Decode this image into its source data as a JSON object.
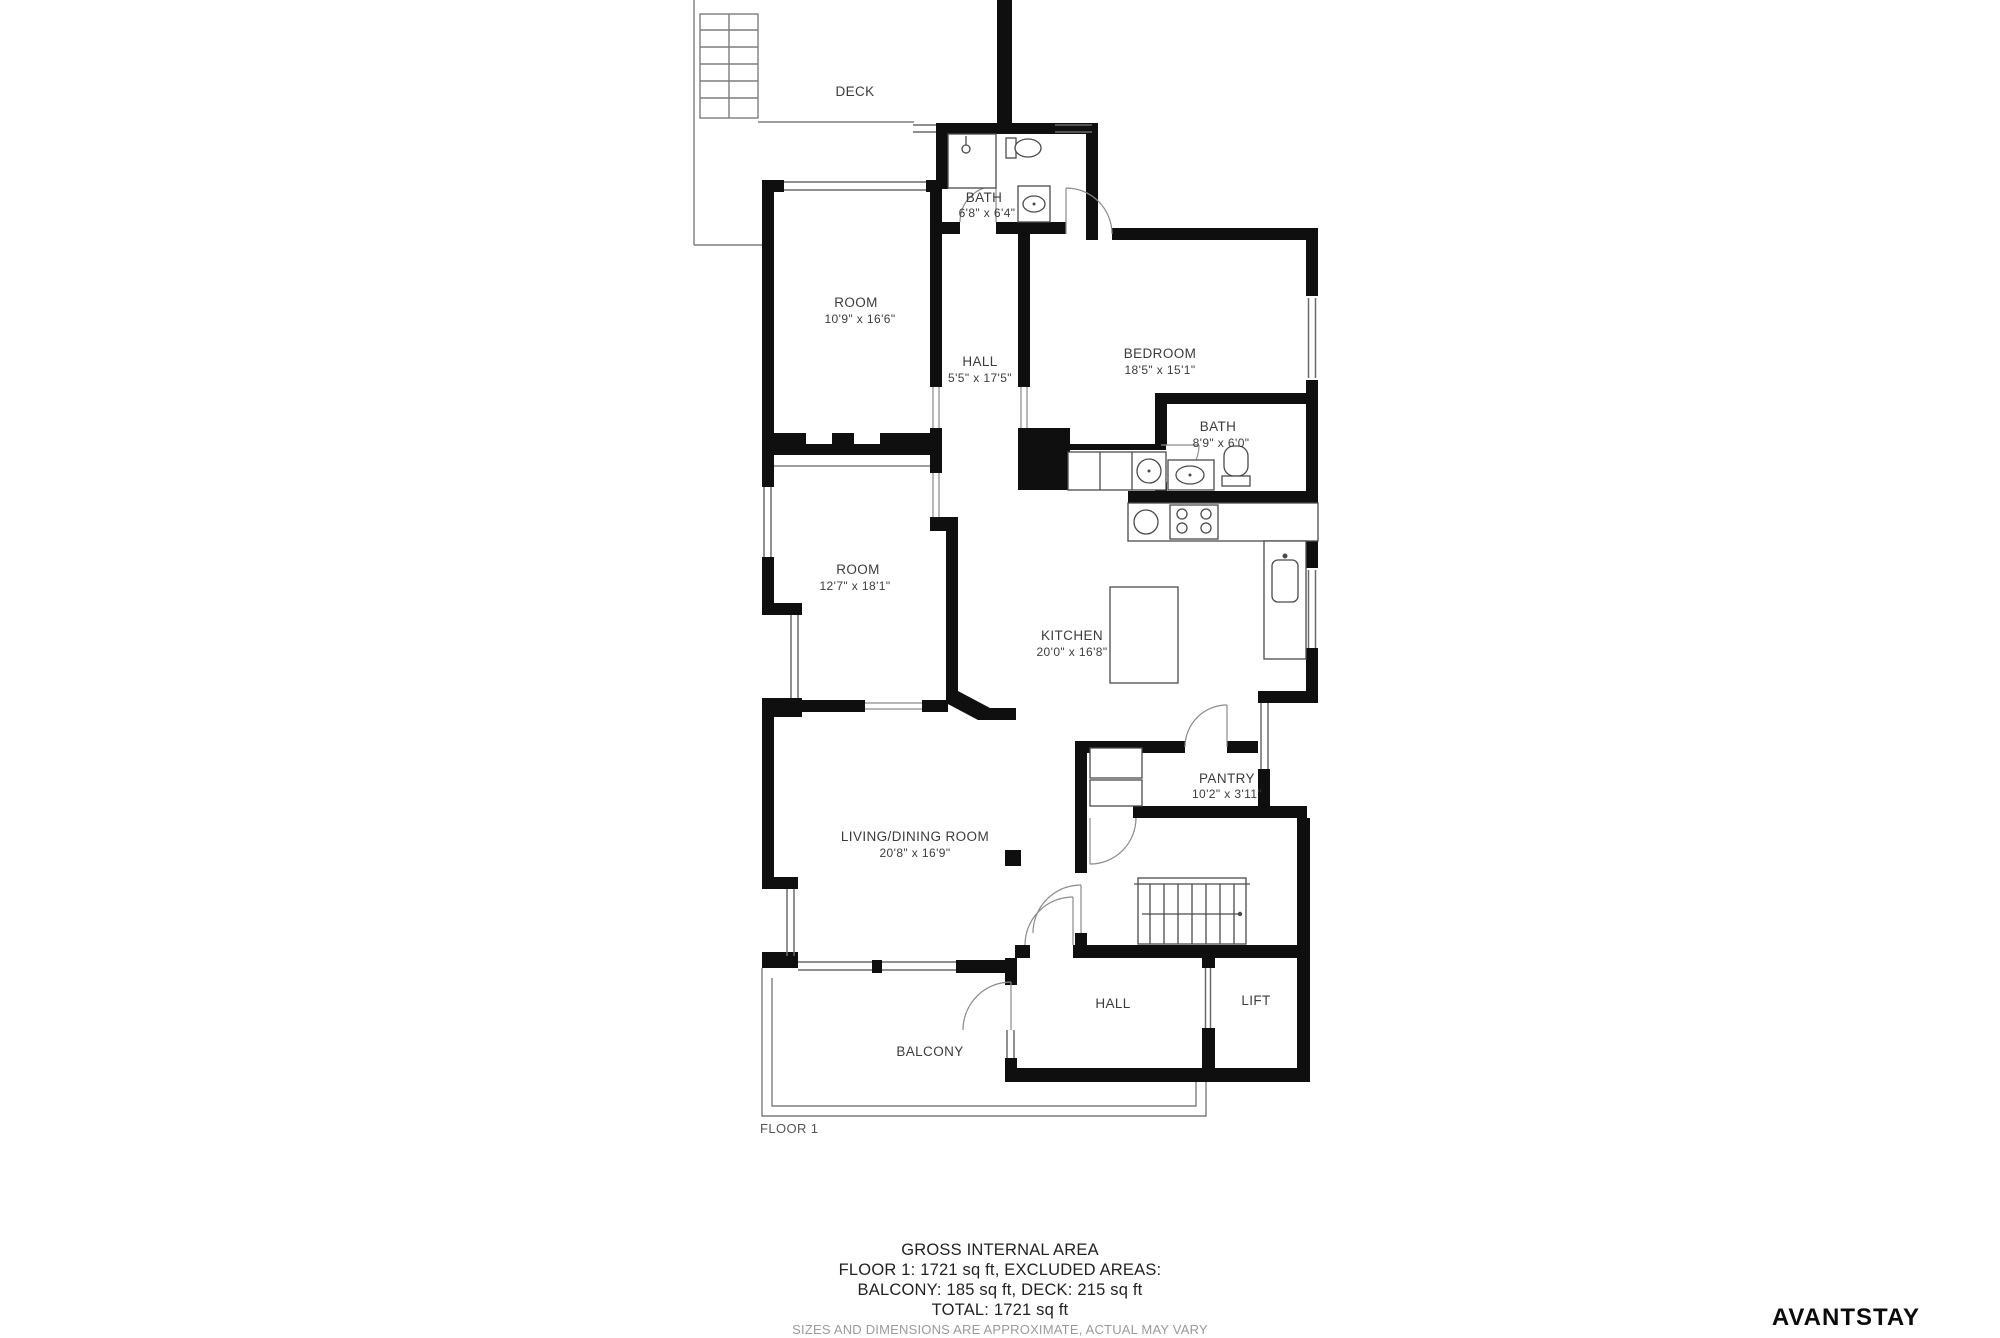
{
  "plan": {
    "floor_label": "FLOOR 1",
    "rooms": {
      "deck": {
        "name": "DECK"
      },
      "bath1": {
        "name": "BATH",
        "dims": "6'8\" x 6'4\""
      },
      "room1": {
        "name": "ROOM",
        "dims": "10'9\" x 16'6\""
      },
      "hall1": {
        "name": "HALL",
        "dims": "5'5\" x 17'5\""
      },
      "bedroom": {
        "name": "BEDROOM",
        "dims": "18'5\" x 15'1\""
      },
      "bath2": {
        "name": "BATH",
        "dims": "8'9\" x 6'0\""
      },
      "room2": {
        "name": "ROOM",
        "dims": "12'7\" x 18'1\""
      },
      "kitchen": {
        "name": "KITCHEN",
        "dims": "20'0\" x 16'8\""
      },
      "pantry": {
        "name": "PANTRY",
        "dims": "10'2\" x 3'11\""
      },
      "living": {
        "name": "LIVING/DINING ROOM",
        "dims": "20'8\" x 16'9\""
      },
      "hall2": {
        "name": "HALL"
      },
      "lift": {
        "name": "LIFT"
      },
      "balcony": {
        "name": "BALCONY"
      }
    }
  },
  "footer": {
    "title": "GROSS INTERNAL AREA",
    "line2": "FLOOR 1: 1721 sq ft, EXCLUDED AREAS:",
    "line3": "BALCONY: 185 sq ft, DECK: 215 sq ft",
    "line4": "TOTAL: 1721 sq ft",
    "disclaimer": "SIZES AND DIMENSIONS ARE APPROXIMATE, ACTUAL MAY VARY"
  },
  "branding": {
    "logo_text": "AVANTSTAY"
  },
  "colors": {
    "wall": "#0f0f0f",
    "thin_line": "#7d7d7d",
    "text": "#3c3c3c"
  }
}
